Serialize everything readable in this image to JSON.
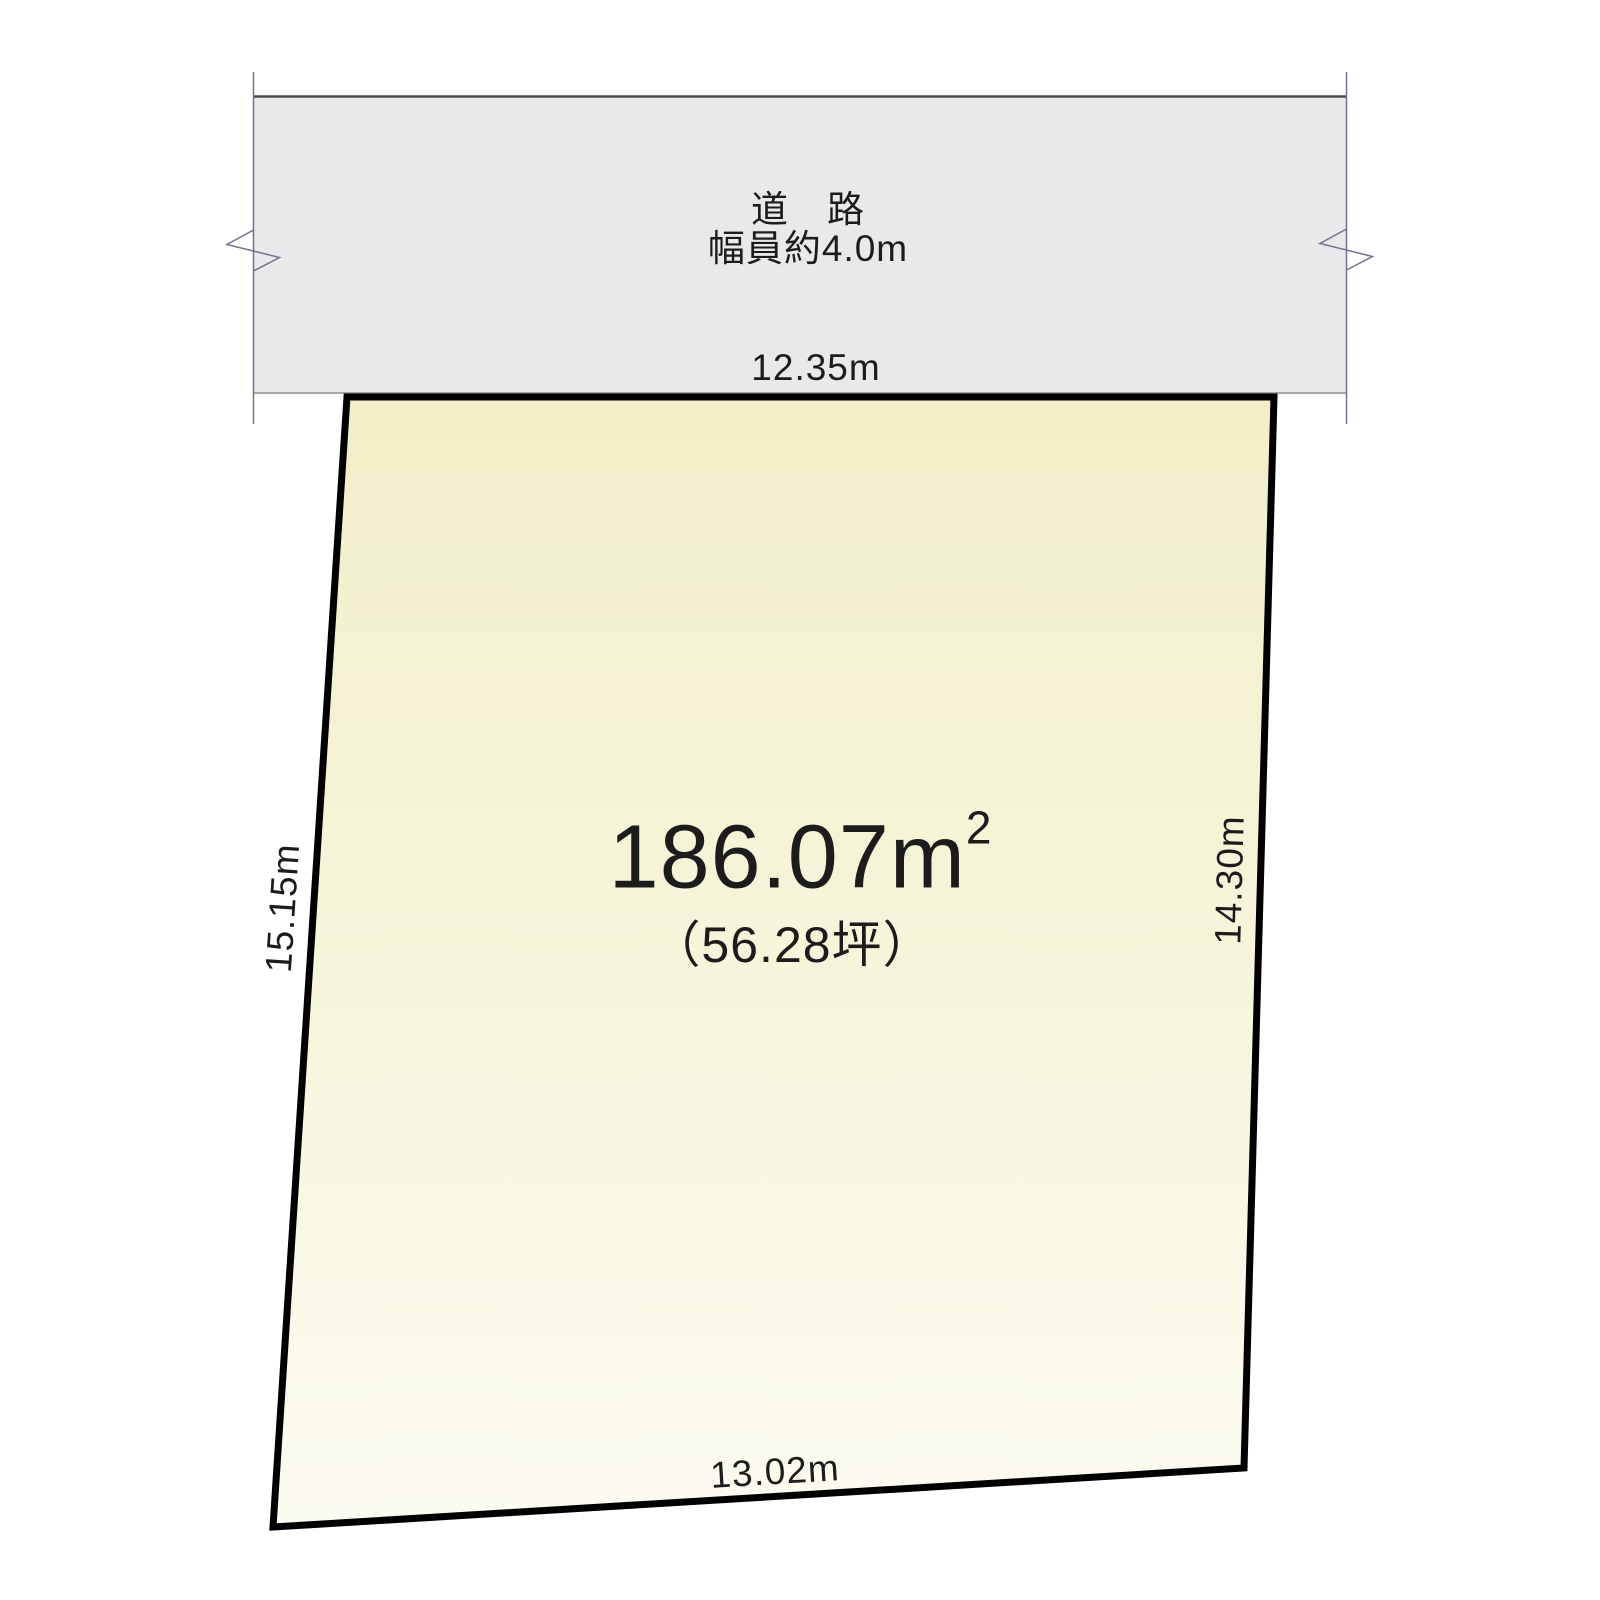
{
  "road": {
    "name": "道　路",
    "width_note": "幅員約4.0m",
    "frontage": "12.35m",
    "fill": "#e9e8ea",
    "top_edge_color": "#4a4a4e",
    "bottom_edge_color": "#8d8d96",
    "boundary_line_color": "#73738f"
  },
  "plot": {
    "area_value": "186.07m",
    "area_sup": "2",
    "area_tsubo": "（56.28坪）",
    "dim_left": "15.15m",
    "dim_right": "14.30m",
    "dim_bottom": "13.02m",
    "fill_top": "#f1efc9",
    "fill_mid": "#f6f5db",
    "fill_bottom": "#fcfbf1",
    "stroke": "#000000"
  }
}
